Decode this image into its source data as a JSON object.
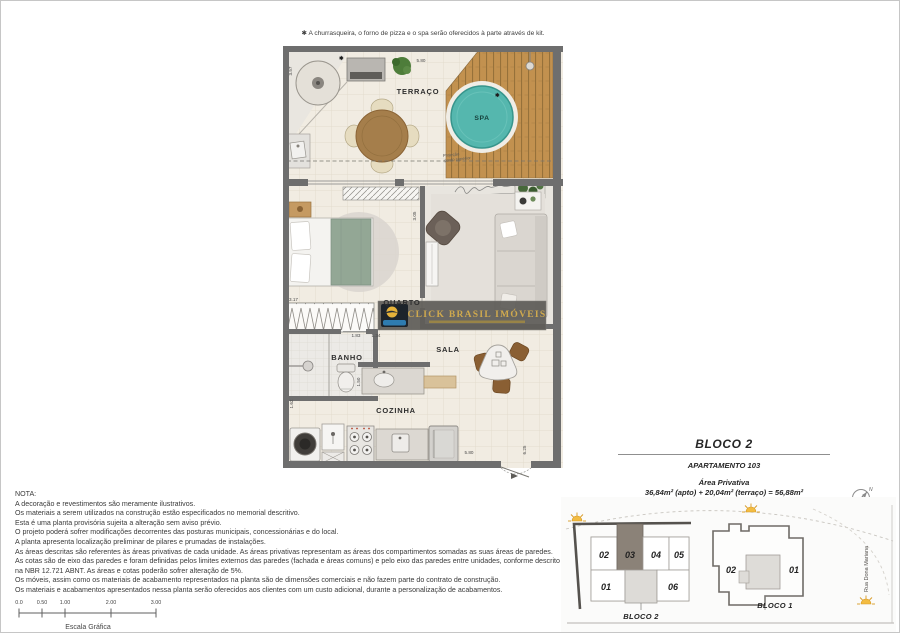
{
  "kit_note": "✱ A churrasqueira, o forno de pizza e o spa serão oferecidos à parte através de kit.",
  "floorplan": {
    "labels": {
      "terraco": "TERRAÇO",
      "spa": "SPA",
      "quarto": "QUARTO",
      "banho": "BANHO",
      "sala": "SALA",
      "cozinha": "COZINHA",
      "projecao_line1": "Projeção",
      "projecao_line2": "pavto superior"
    },
    "dimensions": {
      "terrace_top": "5.80",
      "terrace_left": "3.57",
      "quarto_left": "3.17",
      "quarto_right": "3.05",
      "banho_top_left": "1.83",
      "banho_top_right": "1.34",
      "banho_right": "1.50",
      "cozinha_left": "1.62",
      "cozinha_bottom": "5.80",
      "right_edge": "6.25"
    },
    "kit_star": "✱",
    "watermark": "CLICK BRASIL IMÓVEIS"
  },
  "notes": {
    "title": "NOTA:",
    "lines": [
      "A decoração e revestimentos são meramente ilustrativos.",
      "Os materiais a serem utilizados na construção estão especificados no memorial descritivo.",
      "Esta é uma planta provisória sujeita a alteração sem aviso prévio.",
      "O projeto poderá sofrer modificações decorrentes das posturas municipais, concessionárias e do local.",
      "A planta apresenta localização preliminar de pilares e prumadas de instalações.",
      "As áreas descritas são referentes às áreas privativas de cada unidade. As áreas privativas representam as áreas dos compartimentos somadas as suas áreas de paredes.",
      "As cotas são de eixo das paredes e foram definidas pelos limites externos das paredes (fachada e áreas comuns) e pelo eixo das paredes entre unidades, conforme descrito",
      "na NBR 12.721 ABNT. As áreas e cotas poderão sofrer alteração de 5%.",
      "Os móveis, assim como os materiais de acabamento representados na planta são de dimensões comerciais e não fazem parte do contrato de construção.",
      "Os materiais e acabamentos apresentados nessa planta serão oferecidos aos clientes com um custo adicional, durante a personalização de acabamentos."
    ]
  },
  "scalebar": {
    "ticks": [
      "0.0",
      "0.50",
      "1.00",
      "2.00",
      "3.00"
    ],
    "label": "Escala Gráfica"
  },
  "title_block": {
    "bloco": "BLOCO 2",
    "apartamento": "APARTAMENTO 103",
    "area_title": "Área Privativa",
    "area_value": "36,84m² (apto) + 20,04m² (terraço) = 56,88m²"
  },
  "siteplan": {
    "bloco2_label": "BLOCO 2",
    "bloco1_label": "BLOCO 1",
    "b2_units": {
      "u02": "02",
      "u03": "03",
      "u04": "04",
      "u05": "05",
      "u01": "01",
      "u06": "06"
    },
    "b1_units": {
      "u02": "02",
      "u01": "01"
    },
    "street": "Rua Dona Mariana",
    "north": "N"
  },
  "colors": {
    "wall": "#6e6e6e",
    "deck_wood": "#c2914f",
    "spa_water": "#55b7ae",
    "highlighted_unit": "#8b8278",
    "sun": "#f3bc41",
    "watermark_gold": "#cfa94e"
  }
}
